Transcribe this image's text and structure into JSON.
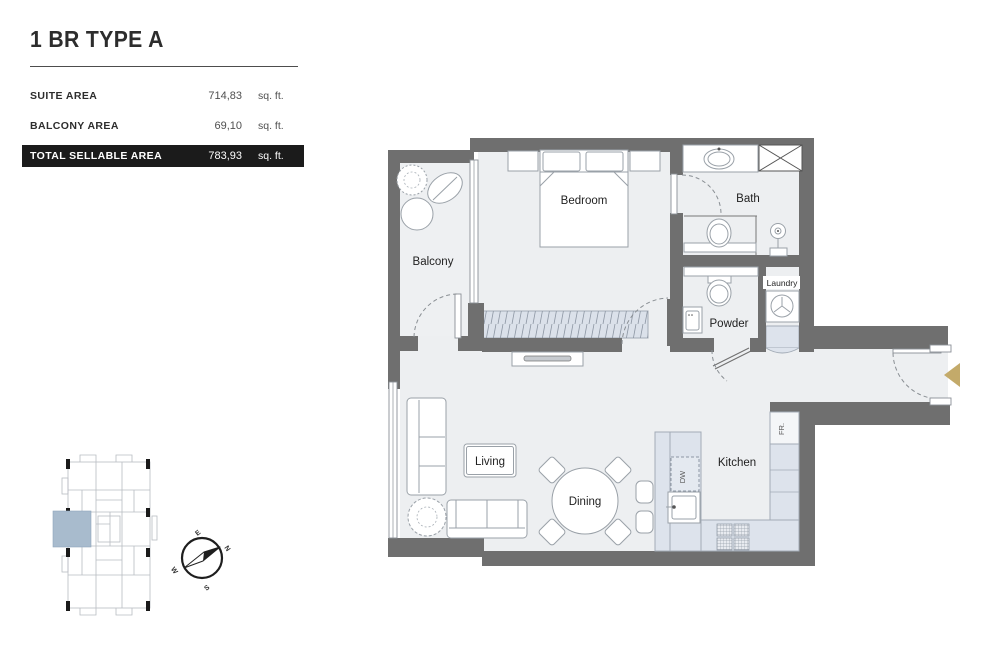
{
  "header": {
    "title": "1 BR TYPE A",
    "rows": [
      {
        "label": "SUITE AREA",
        "value": "714,83",
        "unit": "sq. ft."
      },
      {
        "label": "BALCONY AREA",
        "value": "69,10",
        "unit": "sq. ft."
      },
      {
        "label": "TOTAL SELLABLE AREA",
        "value": "783,93",
        "unit": "sq. ft."
      }
    ]
  },
  "rooms": {
    "balcony": "Balcony",
    "bedroom": "Bedroom",
    "bath": "Bath",
    "powder": "Powder",
    "laundry": "Laundry",
    "living": "Living",
    "dining": "Dining",
    "kitchen": "Kitchen",
    "fridge": "FR.",
    "dishwasher": "DW"
  },
  "compass": {
    "n": "N",
    "e": "E",
    "s": "S",
    "w": "W"
  },
  "colors": {
    "wall": "#6f6f6f",
    "floor": "#edeff1",
    "counter": "#dde3ec",
    "accent_gold": "#c3aa6a",
    "keyplan_highlight": "#a8bbcd",
    "total_bar_bg": "#1b1b1b"
  }
}
